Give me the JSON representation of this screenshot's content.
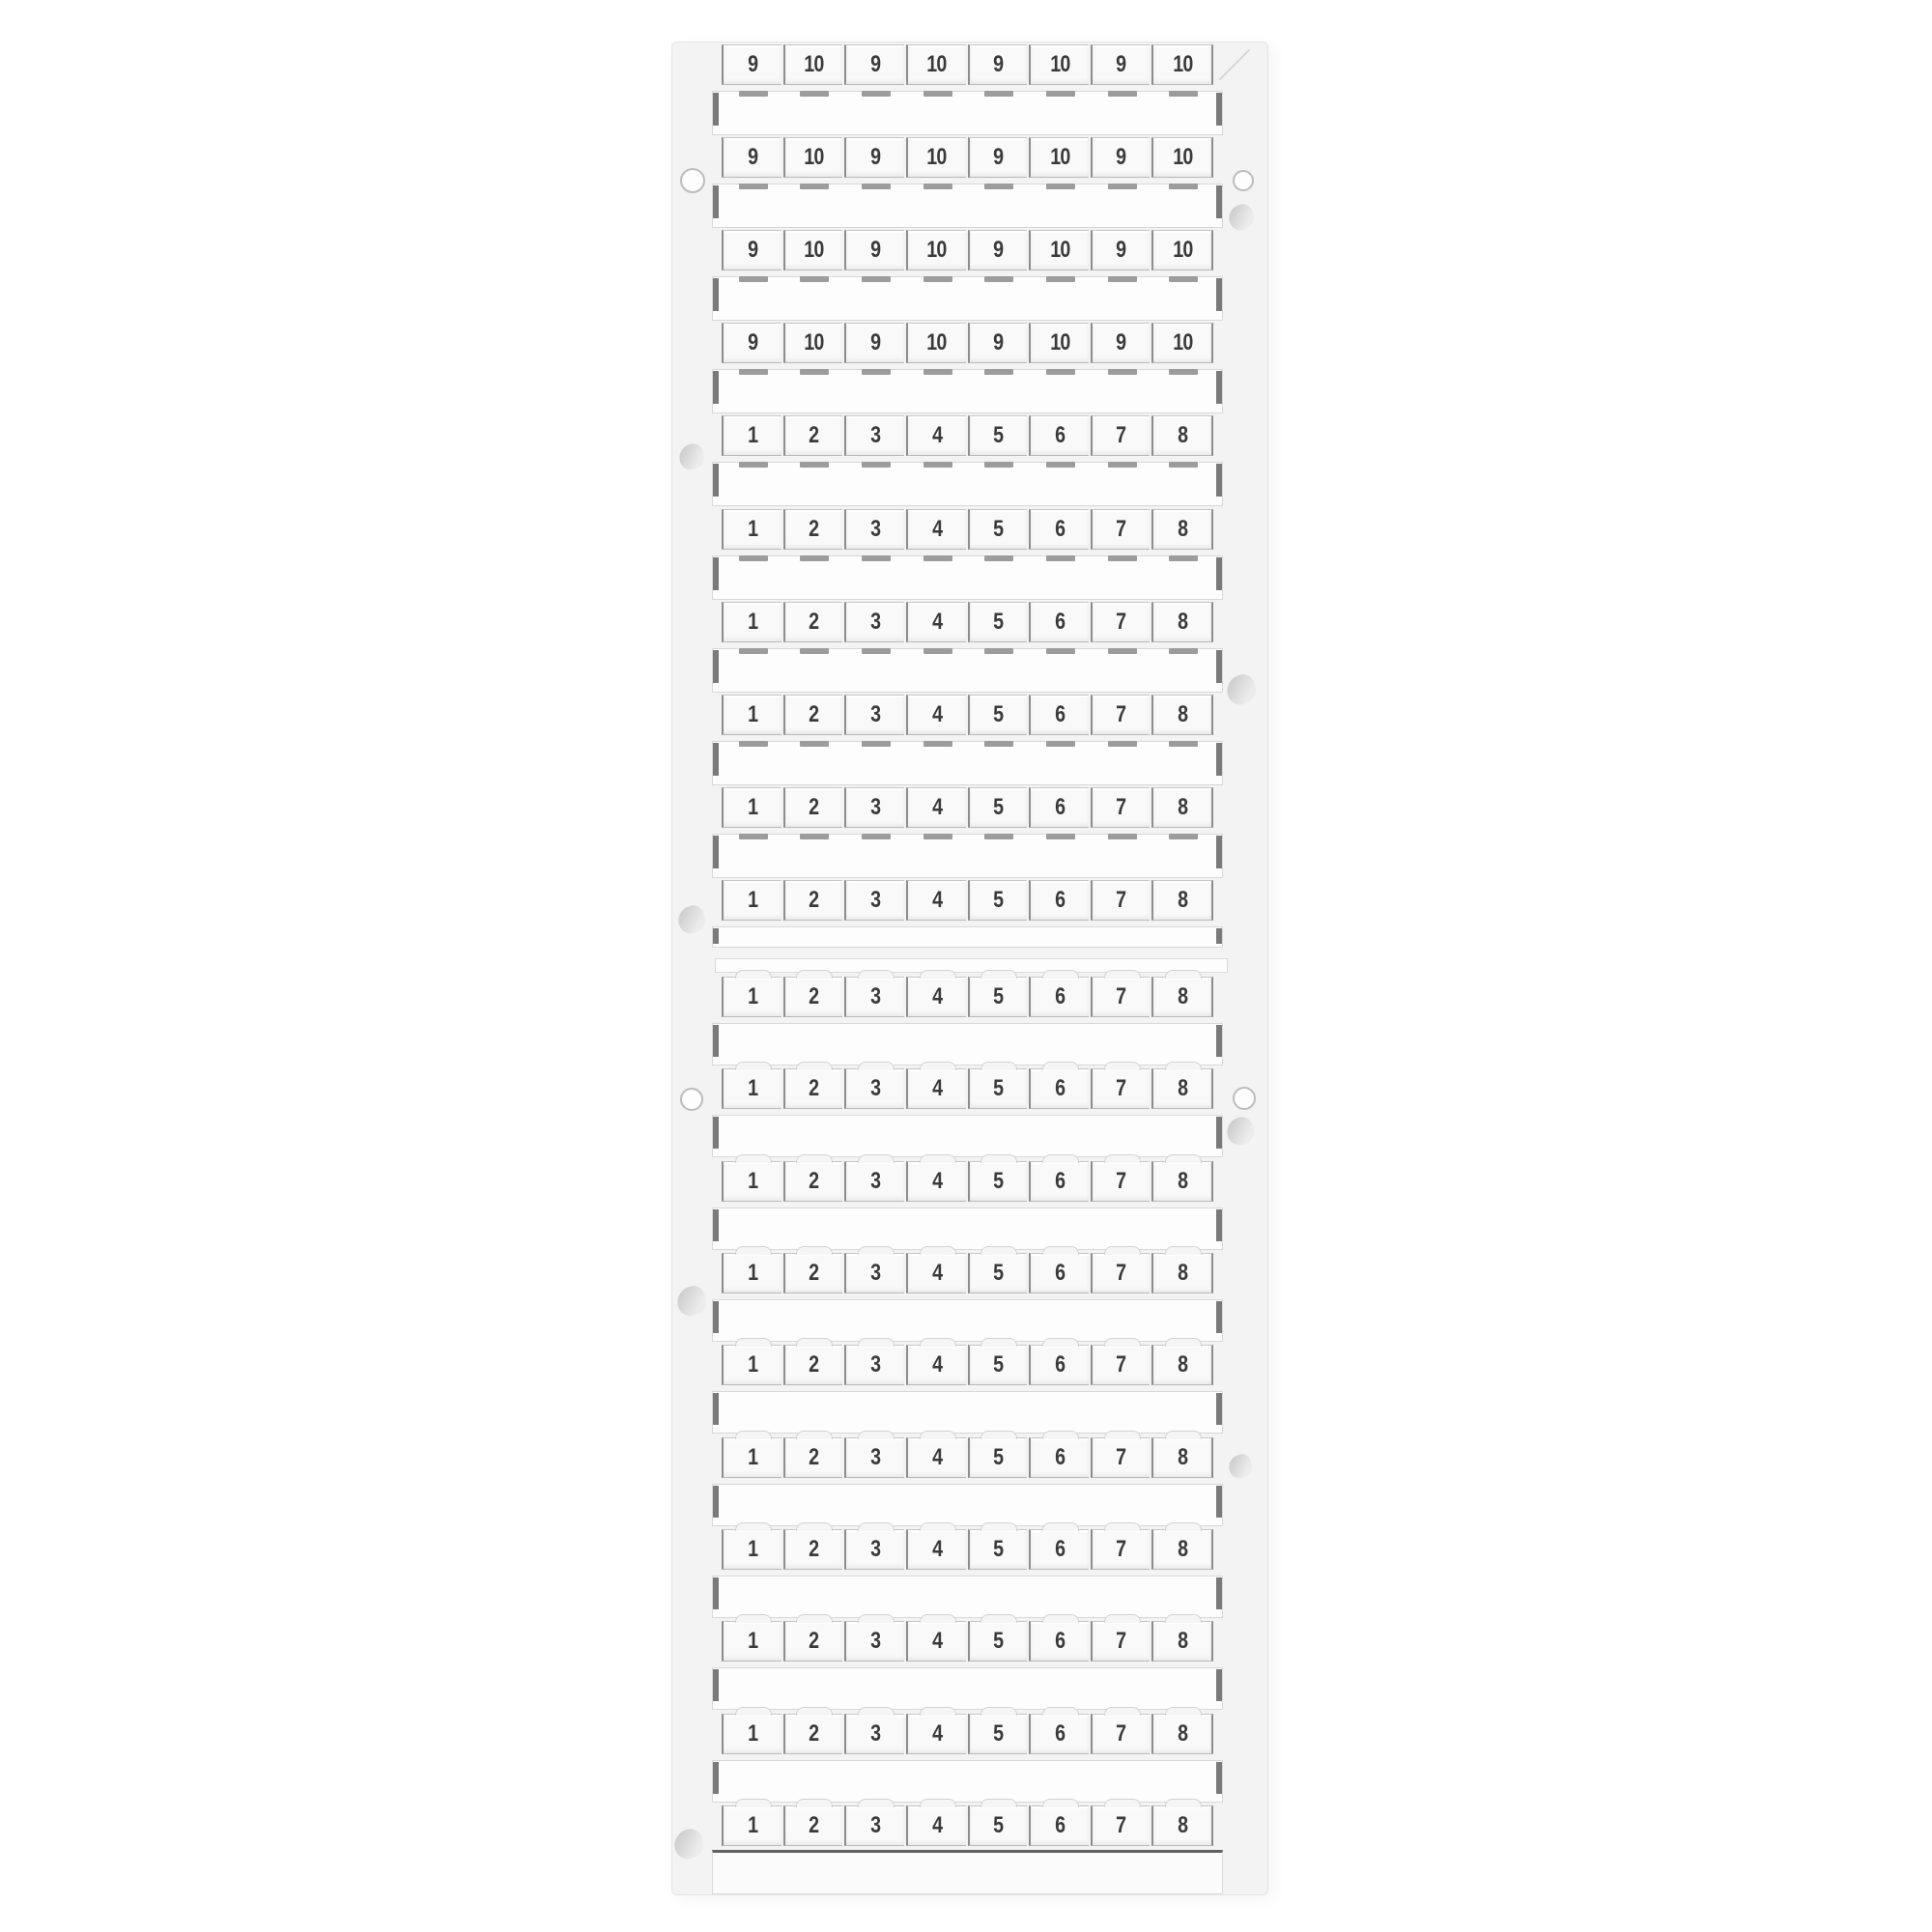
{
  "image": {
    "type": "product-photo",
    "subject": "white terminal-block marker cards with numbered snap-off tags"
  },
  "colors": {
    "background": "#ffffff",
    "card_base": "#f3f3f4",
    "tag_fill": "#f9f9f9",
    "strip_fill": "#fdfdfd",
    "divider_dark": "#8d8d8d",
    "nub_gray": "#9c9c9c",
    "digit": "#3a3a3a"
  },
  "cards": [
    {
      "name": "upper-card",
      "rows": [
        {
          "labels": [
            "9",
            "10",
            "9",
            "10",
            "9",
            "10",
            "9",
            "10"
          ]
        },
        {
          "labels": [
            "9",
            "10",
            "9",
            "10",
            "9",
            "10",
            "9",
            "10"
          ]
        },
        {
          "labels": [
            "9",
            "10",
            "9",
            "10",
            "9",
            "10",
            "9",
            "10"
          ]
        },
        {
          "labels": [
            "9",
            "10",
            "9",
            "10",
            "9",
            "10",
            "9",
            "10"
          ]
        },
        {
          "labels": [
            "1",
            "2",
            "3",
            "4",
            "5",
            "6",
            "7",
            "8"
          ]
        },
        {
          "labels": [
            "1",
            "2",
            "3",
            "4",
            "5",
            "6",
            "7",
            "8"
          ]
        },
        {
          "labels": [
            "1",
            "2",
            "3",
            "4",
            "5",
            "6",
            "7",
            "8"
          ]
        },
        {
          "labels": [
            "1",
            "2",
            "3",
            "4",
            "5",
            "6",
            "7",
            "8"
          ]
        },
        {
          "labels": [
            "1",
            "2",
            "3",
            "4",
            "5",
            "6",
            "7",
            "8"
          ]
        },
        {
          "labels": [
            "1",
            "2",
            "3",
            "4",
            "5",
            "6",
            "7",
            "8"
          ]
        }
      ]
    },
    {
      "name": "lower-card",
      "rows": [
        {
          "labels": [
            "1",
            "2",
            "3",
            "4",
            "5",
            "6",
            "7",
            "8"
          ]
        },
        {
          "labels": [
            "1",
            "2",
            "3",
            "4",
            "5",
            "6",
            "7",
            "8"
          ]
        },
        {
          "labels": [
            "1",
            "2",
            "3",
            "4",
            "5",
            "6",
            "7",
            "8"
          ]
        },
        {
          "labels": [
            "1",
            "2",
            "3",
            "4",
            "5",
            "6",
            "7",
            "8"
          ]
        },
        {
          "labels": [
            "1",
            "2",
            "3",
            "4",
            "5",
            "6",
            "7",
            "8"
          ]
        },
        {
          "labels": [
            "1",
            "2",
            "3",
            "4",
            "5",
            "6",
            "7",
            "8"
          ]
        },
        {
          "labels": [
            "1",
            "2",
            "3",
            "4",
            "5",
            "6",
            "7",
            "8"
          ]
        },
        {
          "labels": [
            "1",
            "2",
            "3",
            "4",
            "5",
            "6",
            "7",
            "8"
          ]
        },
        {
          "labels": [
            "1",
            "2",
            "3",
            "4",
            "5",
            "6",
            "7",
            "8"
          ]
        },
        {
          "labels": [
            "1",
            "2",
            "3",
            "4",
            "5",
            "6",
            "7",
            "8"
          ]
        }
      ]
    }
  ]
}
